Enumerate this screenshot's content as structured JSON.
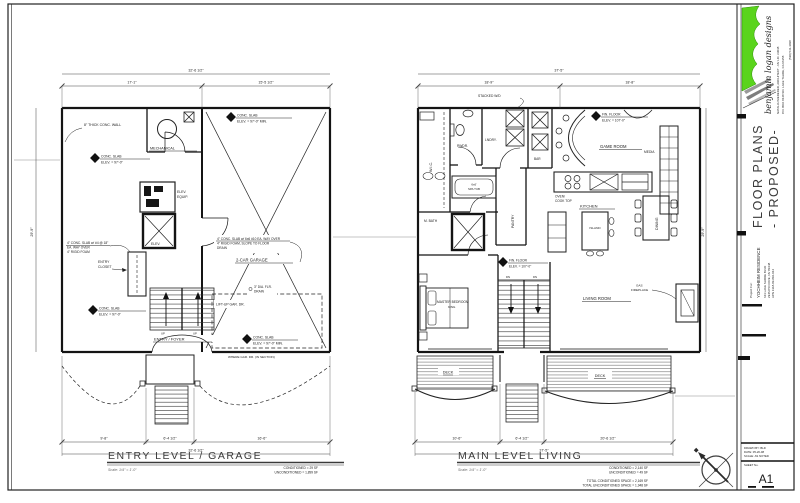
{
  "sheet": {
    "paper_color": "#ffffff",
    "ink_color": "#1b1b1b",
    "logo_green": "#5ad41c",
    "number": "A1"
  },
  "title_block": {
    "firm_name": "benjamin logan designs",
    "firm_credit": "NATALIA WIEDERER, ARCHITECT  -  NV LIC. #3038",
    "firm_address": "P.O. BOX 8448   SO. LAKE TAHOE, CA  96158",
    "firm_phone": "(530) 541-3038",
    "sheet_title_line1": "FLOOR PLANS",
    "sheet_title_line2": "- PROPOSED-",
    "project_label": "Project For:",
    "project_name": "YOCHHEIM RESIDENCE",
    "project_address1": "643 LAKE SHORE BLVD",
    "project_address2": "ZEPHYR COVE, NV 89448",
    "project_apn": "APN 1318-09-810-044",
    "info_drawn": "DRAWN BY:  BLD",
    "info_date": "DATE:  05-20-08",
    "info_scale": "SCALE:  AS NOTED",
    "sheet_no_label": "SHEET No."
  },
  "entry_plan": {
    "title": "ENTRY LEVEL / GARAGE",
    "scale_note": "Scale:  1/4\" = 1'-0\"",
    "area1": "CONDITIONED  =  29 SF",
    "area2": "UNCONDITIONED  =  1,899 SF",
    "labels": {
      "mechanical": "MECHANICAL",
      "elev_equip1": "ELEV.",
      "elev_equip2": "EQUIP.",
      "elevator": "ELEV.",
      "closet1": "ENTRY",
      "closet2": "CLOSET",
      "foyer": "ENTRY / FOYER",
      "up": "UP",
      "garage": "2-CAR GARAGE",
      "wall_note": "8\" THICK CONC. WALL",
      "slab_title": "CONC. SLAB",
      "slab_elev": "ELEV. = 97'-0\"",
      "slab_elev_min": "ELEV. = 97'-0\" MIN.",
      "entry_note1": "4\" CONC. SLAB w/ #4 @ 18\"",
      "entry_note2": "EA. WAY OVER",
      "entry_note3": "4\" RIGID FOAM",
      "garage_note1": "4\" CONC. SLAB w/ 6x6 #10 EA. WAY OVER",
      "garage_note2": "4\" RIGID FOAM, SLOPE TO FLOOR",
      "garage_note3": "DRAIN",
      "drain1": "3\" DIA. FLR.",
      "drain2": "DRAIN",
      "lift": "LIFT-UP GAR. DR.",
      "section_note": "WHERE GAR. DR. (IN SECTION)"
    },
    "dims": {
      "top_left": "17'-1\"",
      "top_right": "15'-5 1/2\"",
      "top_overall": "32'-6 1/2\"",
      "bottom_1": "9'-8\"",
      "bottom_2": "6'-4 1/2\"",
      "bottom_3": "16'-6\"",
      "bottom_overall": "32'-6 1/2\"",
      "side": "29'-9\""
    }
  },
  "main_plan": {
    "title": "MAIN LEVEL LIVING",
    "scale_note": "Scale:  1/4\" = 1'-0\"",
    "area1": "CONDITIONED  =  2,140 SF",
    "area2": "UNCONDITIONED  =  49 SF",
    "area3": "TOTAL CONDITIONED SPACE  =  2,169 SF",
    "area4": "TOTAL UNCONDITIONED SPACE  =  1,948 SF",
    "labels": {
      "stacked_wd": "STACKED W/D",
      "pwdr": "PWDR.",
      "lndry": "LNDRY.",
      "wic": "W.I.C.",
      "bar": "BAR",
      "game_room": "GAME ROOM",
      "media": "MEDIA",
      "fin_floor1": "FIN. FLOOR",
      "fin_floor2": "ELEV. = 107'-0\"",
      "kitchen": "KITCHEN",
      "oven1": "OVEN/",
      "oven2": "COOK TOP",
      "island": "ISLAND",
      "dining": "DINING",
      "mbath": "M. BATH",
      "spa1": "6x6'",
      "spa2": "SPA TUB",
      "pantry": "PANTRY",
      "master1": "MASTER BEDROOM",
      "master2": "KING",
      "dn": "DN",
      "living": "LIVING ROOM",
      "fp1": "GAS",
      "fp2": "FIREPLACE",
      "deck": "DECK"
    },
    "dims": {
      "top_left": "18'-9\"",
      "top_right": "18'-8\"",
      "top_overall": "37'-5\"",
      "bottom_1": "10'-6\"",
      "bottom_2": "6'-4 1/2\"",
      "bottom_3": "20'-6 1/2\"",
      "bottom_overall": "37'-5\"",
      "side": "29'-9\""
    }
  }
}
